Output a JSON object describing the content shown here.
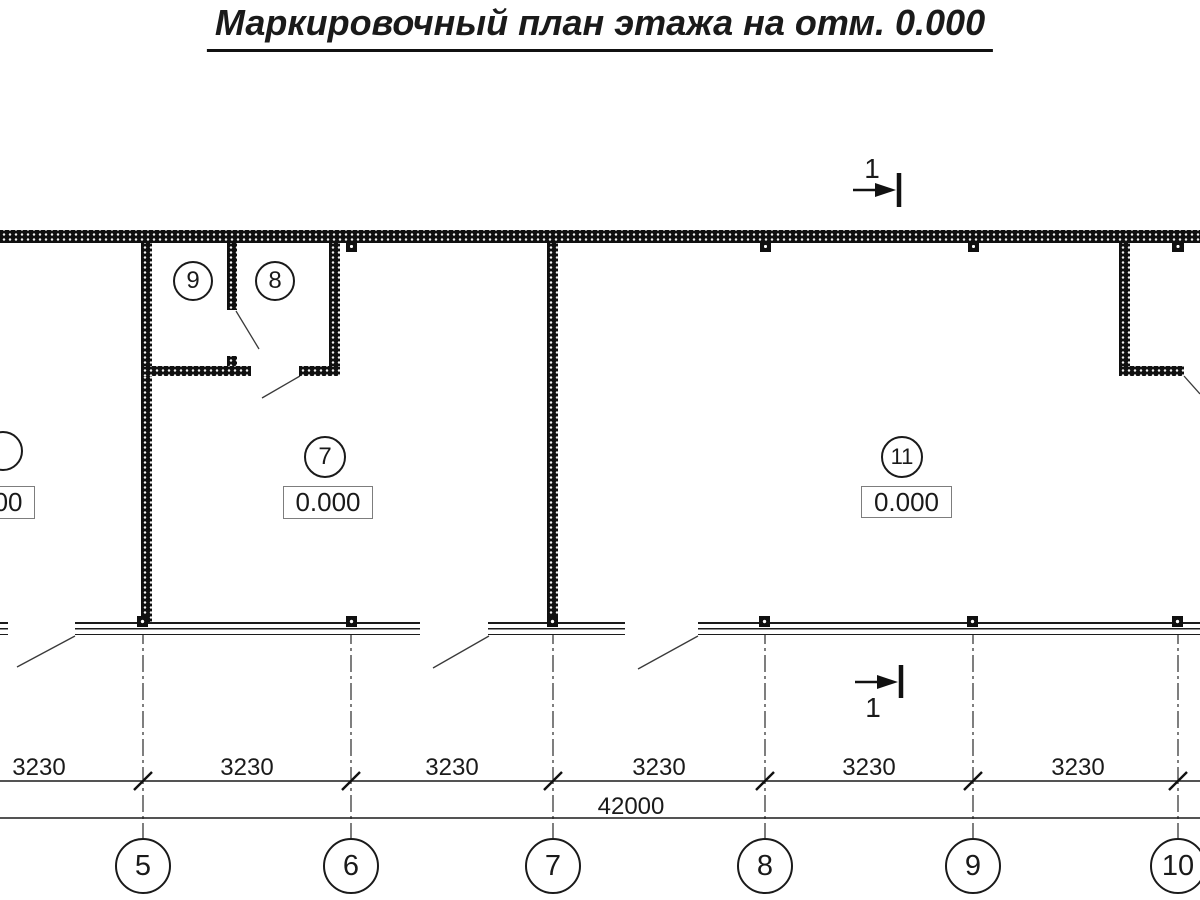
{
  "drawing": {
    "title": "Маркировочный план этажа на отм. 0.000"
  },
  "section_marks": {
    "top_label": "1",
    "bottom_label": "1"
  },
  "rooms": {
    "r9": {
      "number": "9"
    },
    "r8": {
      "number": "8"
    },
    "r7": {
      "number": "7",
      "level": "0.000"
    },
    "r11": {
      "number": "11",
      "level": "0.000"
    },
    "r_left_cut": {
      "level": "0.000"
    }
  },
  "dimensions": {
    "bays": [
      "3230",
      "3230",
      "3230",
      "3230",
      "3230",
      "3230"
    ],
    "total": "42000"
  },
  "axes": [
    "5",
    "6",
    "7",
    "8",
    "9",
    "10"
  ]
}
